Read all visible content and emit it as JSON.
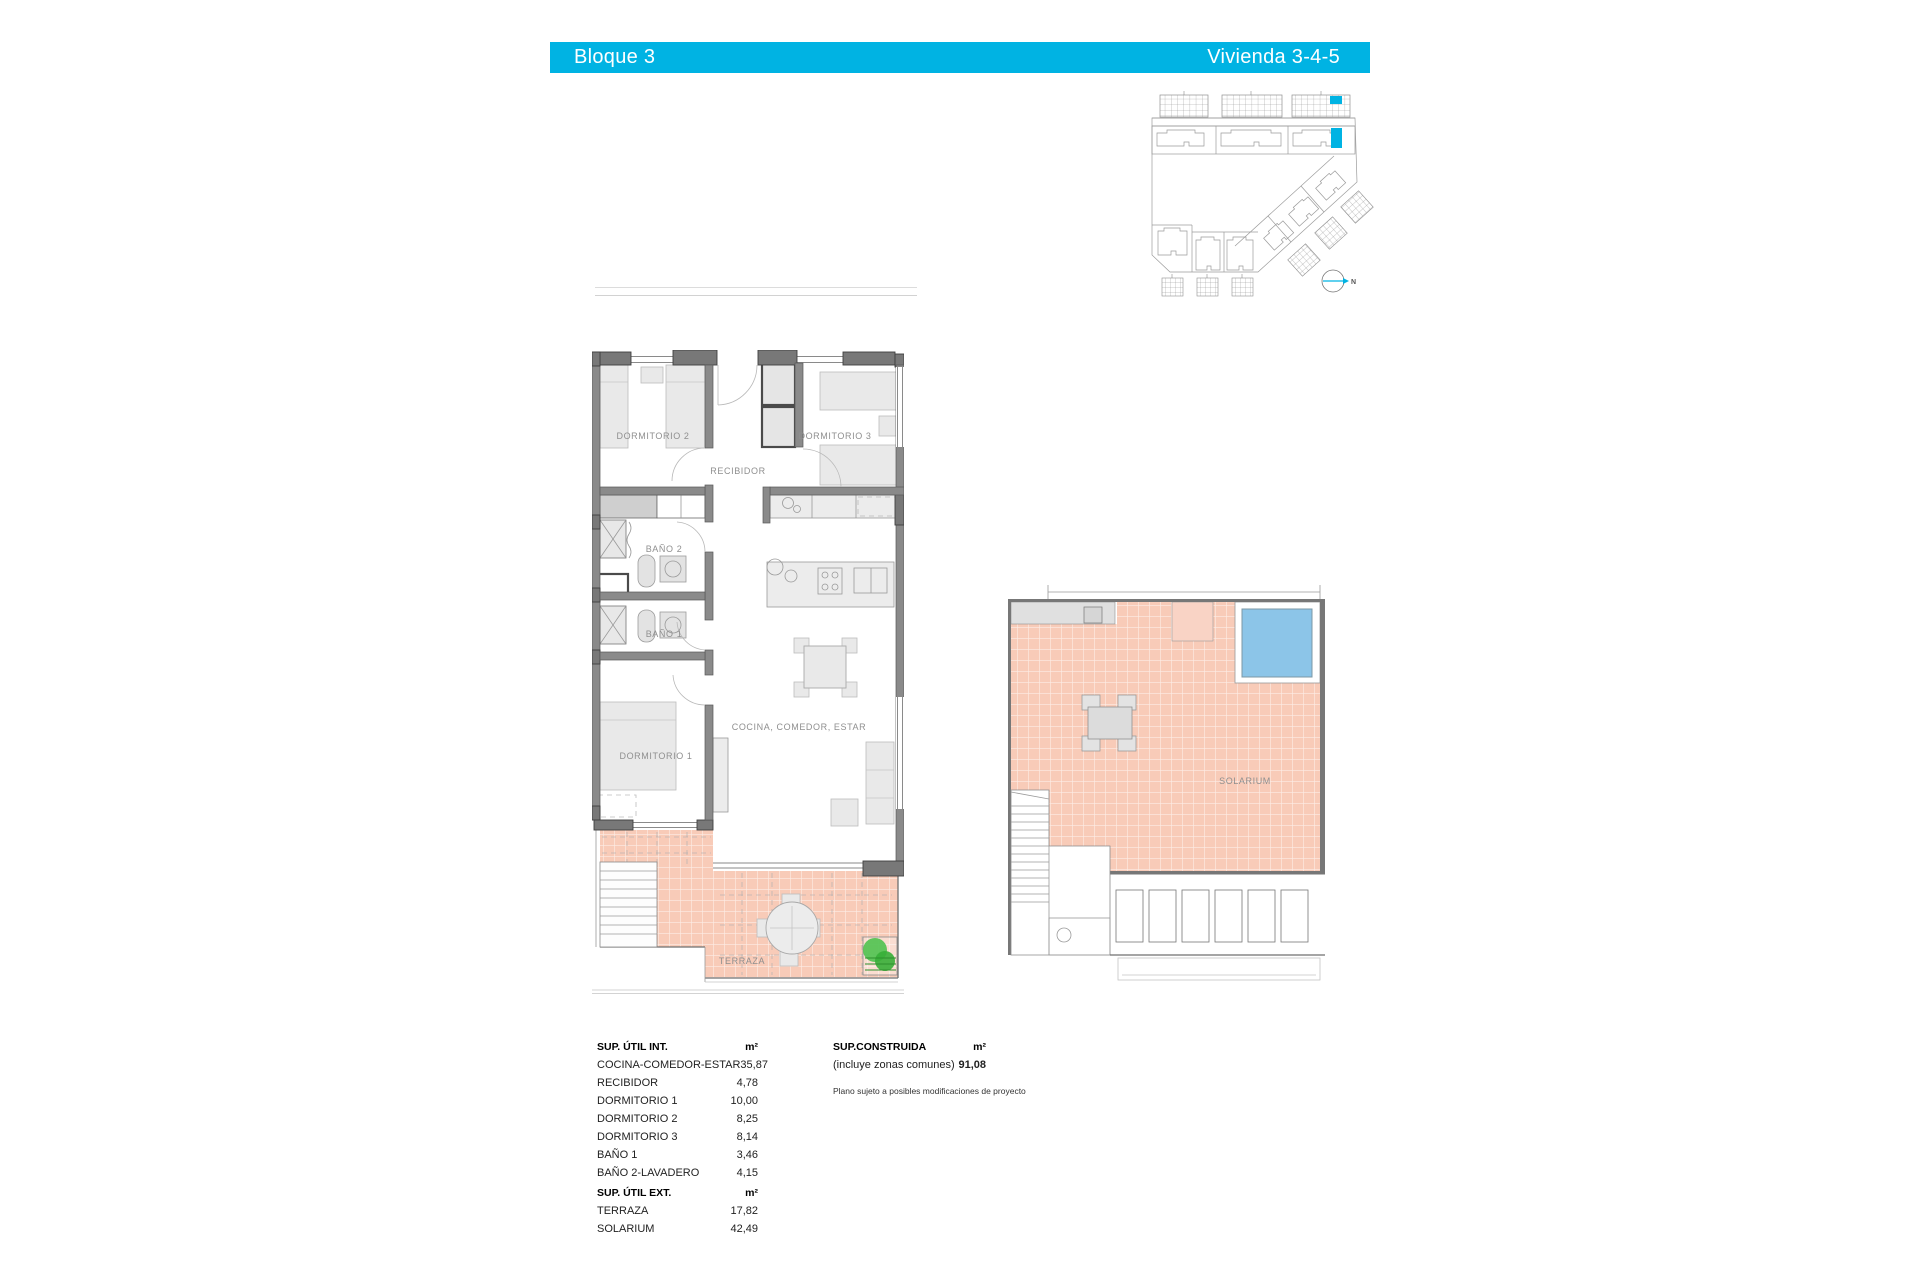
{
  "header": {
    "left_title": "Bloque 3",
    "right_title": "Vivienda 3-4-5"
  },
  "site_plan": {
    "north_label": "N"
  },
  "main_plan": {
    "labels": {
      "dormitorio2": "DORMITORIO 2",
      "dormitorio3": "DORMITORIO 3",
      "recibidor": "RECIBIDOR",
      "bano2": "BAÑO 2",
      "bano1": "BAÑO 1",
      "dormitorio1": "DORMITORIO 1",
      "cocina": "COCINA, COMEDOR, ESTAR",
      "terraza": "TERRAZA"
    }
  },
  "solarium_plan": {
    "label": "SOLARIUM"
  },
  "surface_tables": {
    "util_int": {
      "title": "SUP. ÚTIL INT.",
      "unit": "m²",
      "rows": [
        {
          "label": "COCINA-COMEDOR-ESTAR",
          "value": "35,87"
        },
        {
          "label": "RECIBIDOR",
          "value": "4,78"
        },
        {
          "label": "DORMITORIO 1",
          "value": "10,00"
        },
        {
          "label": "DORMITORIO 2",
          "value": "8,25"
        },
        {
          "label": "DORMITORIO 3",
          "value": "8,14"
        },
        {
          "label": "BAÑO 1",
          "value": "3,46"
        },
        {
          "label": "BAÑO 2-LAVADERO",
          "value": "4,15"
        }
      ]
    },
    "util_ext": {
      "title": "SUP. ÚTIL EXT.",
      "unit": "m²",
      "rows": [
        {
          "label": "TERRAZA",
          "value": "17,82"
        },
        {
          "label": "SOLARIUM",
          "value": "42,49"
        }
      ]
    },
    "construida": {
      "title": "SUP.CONSTRUIDA",
      "unit": "m²",
      "rows": [
        {
          "label": "(incluye zonas comunes)",
          "value": "91,08"
        }
      ]
    },
    "footnote": "Plano sujeto a posibles modificaciones de proyecto"
  },
  "colors": {
    "accent": "#00b3e3",
    "terrace_pink": "#f8cbb8",
    "pool_blue": "#8cc5e8",
    "plant_green": "#4fc24f"
  }
}
